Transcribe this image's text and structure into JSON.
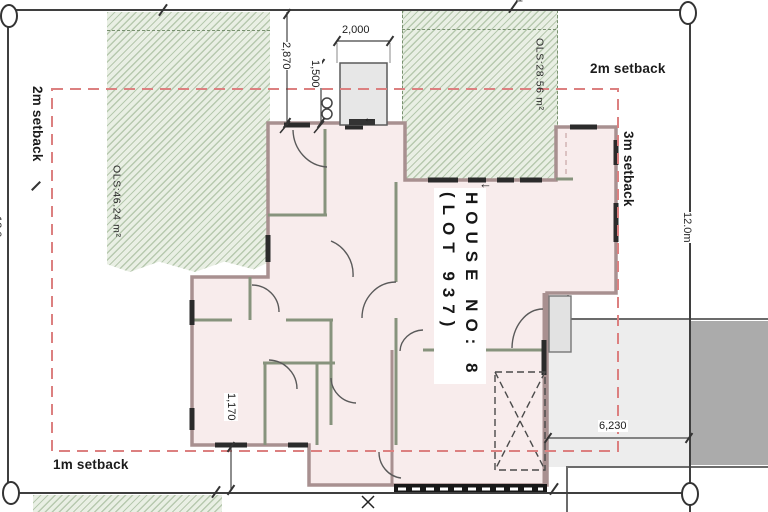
{
  "drawing": {
    "title_line1": "HOUSE NO: 8",
    "title_line2": "(LOT 937)"
  },
  "setbacks": {
    "left": "2m setback",
    "top": "2m setback",
    "right": "3m setback",
    "bottom": "1m setback"
  },
  "open_space": {
    "left_area": "OLS:46.24 m²",
    "right_area": "OLS:28.56 m²"
  },
  "boundaries": {
    "right_length": "12.0m",
    "left_length": "12.0m",
    "peg_label": "d"
  },
  "dimensions": {
    "porch_width": "2,000",
    "front_setback": "2,870",
    "porch_depth": "1,500",
    "rear_gap": "1,170",
    "driveway": "6,230"
  },
  "icons": {
    "entry_arrow": "←"
  },
  "colors": {
    "setback_dash": "#dc8080",
    "hatch_line": "#b7c9af",
    "hatch_bg": "#e9efe4",
    "house_fill": "#f8ecec",
    "exterior_wall": "#a89090",
    "interior_wall": "#87937d",
    "driveway": "#ededed",
    "road": "#ababab",
    "boundary_line": "#3f3f3f"
  }
}
